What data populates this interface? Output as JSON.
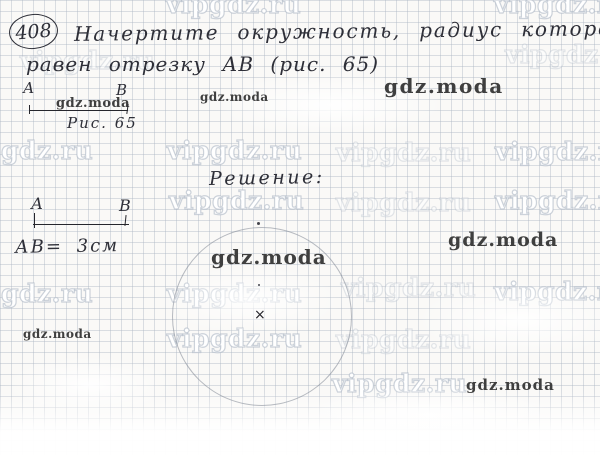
{
  "task": {
    "number": "408"
  },
  "problem": {
    "line1": "Начертите окружность, радиус которой",
    "line2": "равен отрезку АВ (рис. 65)"
  },
  "figure1": {
    "point_a": "А",
    "point_b": "В",
    "caption": "Рис. 65"
  },
  "solution": {
    "heading": "Решение:",
    "measure": "АВ= 3см",
    "figure2": {
      "point_a": "А",
      "point_b": "В"
    },
    "circle_center_mark": "×"
  },
  "watermarks": {
    "site": "vipgdz.ru",
    "brand": "gdz.moda"
  },
  "colors": {
    "ink": "#2e2f38",
    "grid_line": "#a8b2c0",
    "site_outline": "#adb7c4",
    "brand_text": "#3f3f3f",
    "paper": "#faf9f7"
  }
}
